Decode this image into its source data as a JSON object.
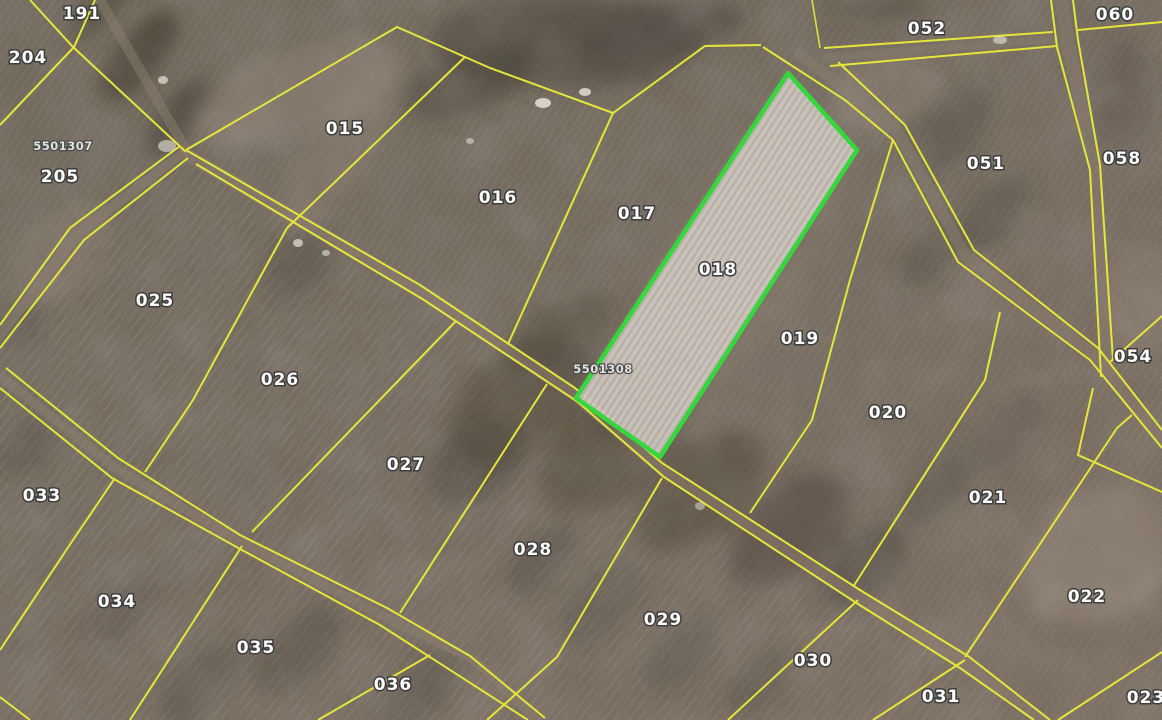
{
  "view": {
    "kind": "cadastral-parcel-satellite-map"
  },
  "colors": {
    "boundary_line": "#e6e63a",
    "highlight_border": "#35d83c",
    "highlight_fill": "#cac3bb",
    "label_fill": "#fafafa",
    "label_outline": "#3d3d3d"
  },
  "highlighted_parcel": {
    "number": "018",
    "reference": "5501308"
  },
  "labels": [
    {
      "text": "191"
    },
    {
      "text": "204"
    },
    {
      "text": "5501307"
    },
    {
      "text": "205"
    },
    {
      "text": "015"
    },
    {
      "text": "016"
    },
    {
      "text": "017"
    },
    {
      "text": "018"
    },
    {
      "text": "019"
    },
    {
      "text": "5501308"
    },
    {
      "text": "020"
    },
    {
      "text": "021"
    },
    {
      "text": "022"
    },
    {
      "text": "023"
    },
    {
      "text": "025"
    },
    {
      "text": "026"
    },
    {
      "text": "027"
    },
    {
      "text": "028"
    },
    {
      "text": "029"
    },
    {
      "text": "030"
    },
    {
      "text": "031"
    },
    {
      "text": "033"
    },
    {
      "text": "034"
    },
    {
      "text": "035"
    },
    {
      "text": "036"
    },
    {
      "text": "051"
    },
    {
      "text": "052"
    },
    {
      "text": "054"
    },
    {
      "text": "058"
    },
    {
      "text": "060"
    }
  ]
}
